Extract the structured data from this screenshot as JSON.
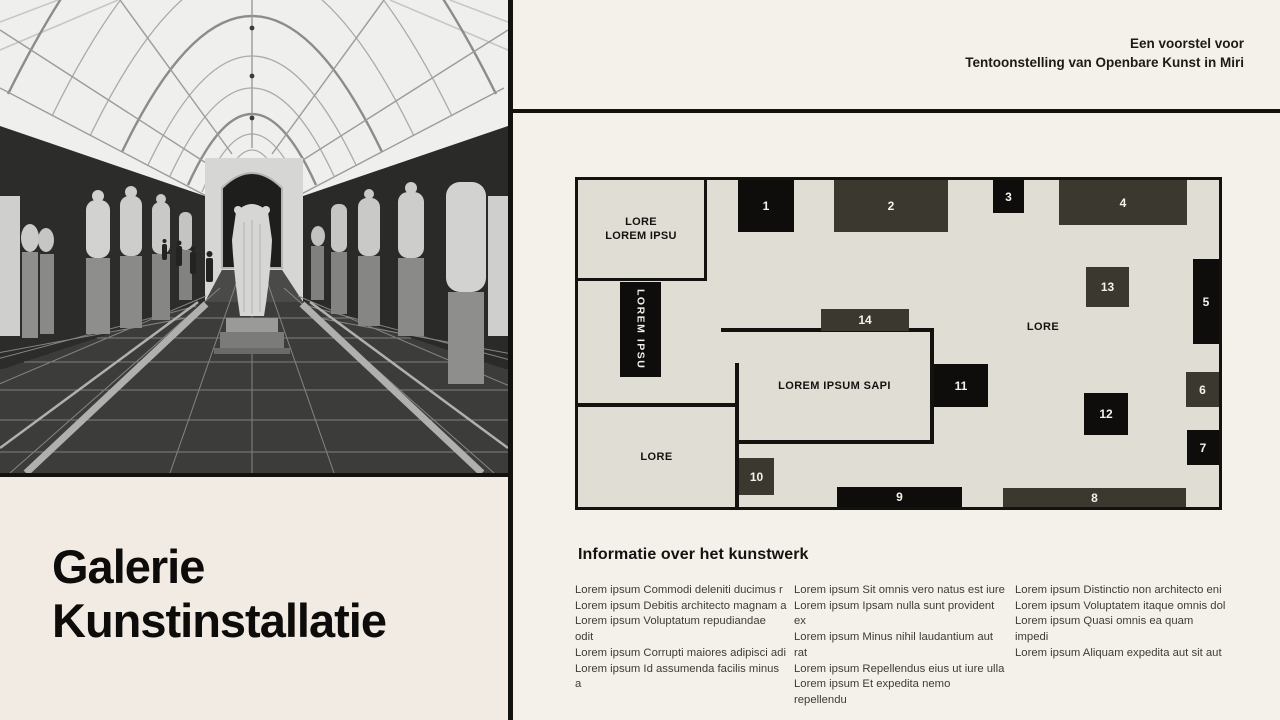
{
  "header": {
    "line1": "Een voorstel voor",
    "line2": "Tentoonstelling van Openbare Kunst in Miri"
  },
  "title": {
    "line1": "Galerie",
    "line2": "Kunstinstallatie"
  },
  "plan": {
    "room_top_left": {
      "line1": "LORE",
      "line2": "LOREM IPSU"
    },
    "vertical_label": "LOREM IPSU",
    "center_room_label": "LOREM IPSUM SAPI",
    "bottom_left_room_label": "LORE",
    "open_area_label": "LORE",
    "box_labels": [
      "1",
      "2",
      "3",
      "4",
      "5",
      "6",
      "7",
      "8",
      "9",
      "10",
      "11",
      "12",
      "13",
      "14"
    ]
  },
  "info": {
    "heading": "Informatie over het kunstwerk",
    "columns": [
      [
        "Lorem ipsum Commodi deleniti ducimus r",
        "Lorem ipsum Debitis architecto magnam a",
        "Lorem ipsum Voluptatum repudiandae odit",
        "Lorem ipsum Corrupti maiores adipisci adi",
        "Lorem ipsum Id assumenda facilis minus a"
      ],
      [
        "Lorem ipsum Sit omnis vero natus est iure",
        "Lorem ipsum Ipsam nulla sunt provident ex",
        "Lorem ipsum Minus nihil laudantium aut rat",
        "Lorem ipsum Repellendus eius ut iure ulla",
        "Lorem ipsum Et expedita nemo repellendu"
      ],
      [
        "Lorem ipsum Distinctio non architecto eni",
        "Lorem ipsum Voluptatem itaque omnis dol",
        "Lorem ipsum Quasi omnis ea quam impedi",
        "Lorem ipsum Aliquam expedita aut sit aut"
      ]
    ]
  },
  "colors": {
    "ink_black": "#14120f",
    "box_black": "#0e0d0b",
    "box_gray": "#3b382f",
    "plan_fill": "#e0ddd5",
    "background_left": "#f1ebe3",
    "background_right": "#f4f0ea"
  }
}
